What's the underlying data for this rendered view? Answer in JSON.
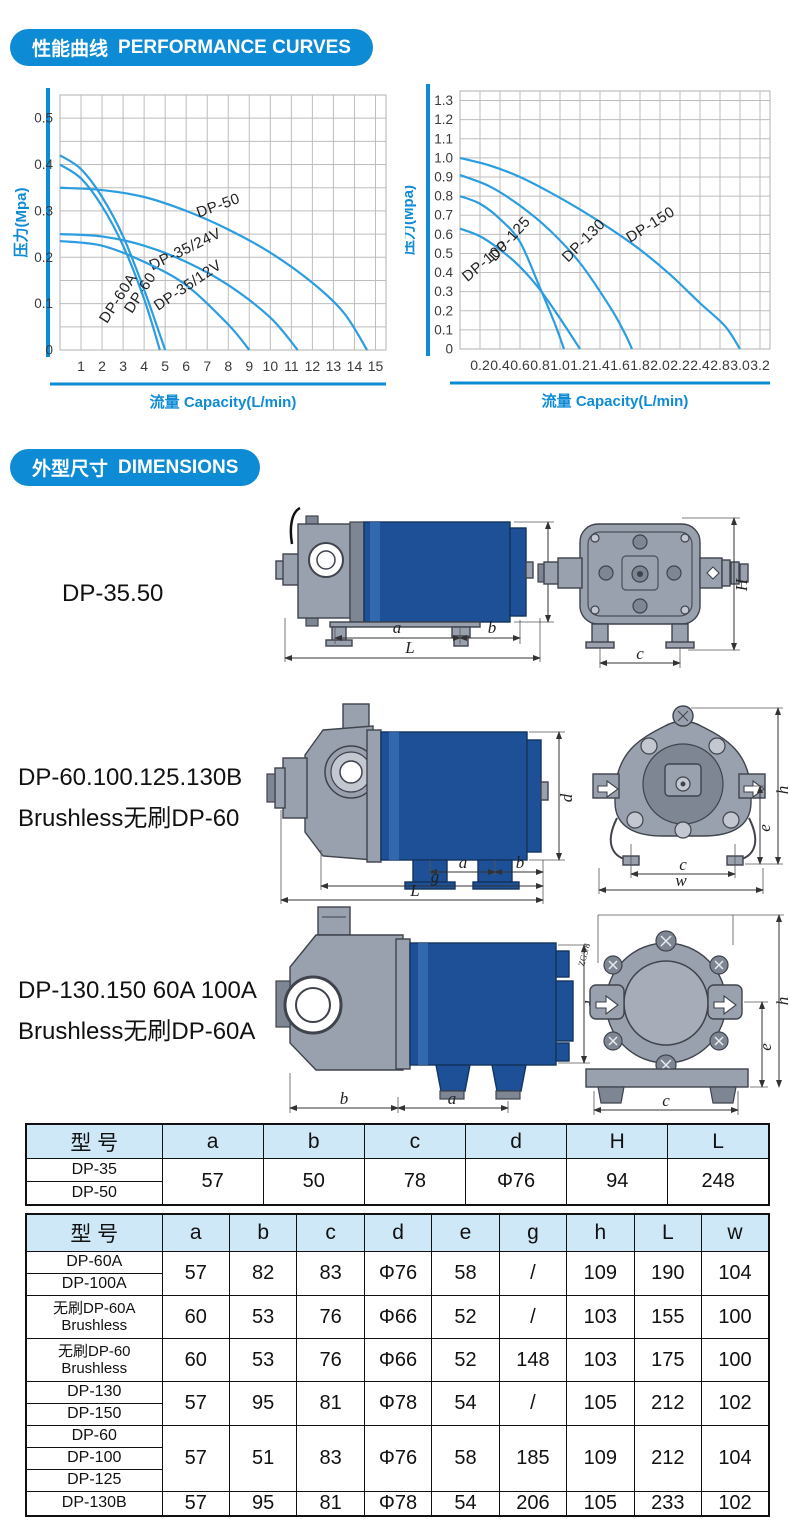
{
  "page": {
    "accent_blue": "#0e8bd5",
    "curve_blue": "#2b9de0",
    "grid_grey": "#bdbdbd",
    "table_header_bg": "#cfe8f8",
    "pump_blue": "#1d5096",
    "pump_grey": "#9aa1ae"
  },
  "sections": {
    "performance": {
      "title_cn": "性能曲线",
      "title_en": "PERFORMANCE CURVES"
    },
    "dimensions": {
      "title_cn": "外型尺寸",
      "title_en": "DIMENSIONS"
    }
  },
  "chart_data": [
    {
      "type": "line",
      "title": "",
      "xlabel": "流量 Capacity(L/min)",
      "ylabel": "压力(Mpa)",
      "xlim": [
        0,
        15.5
      ],
      "ylim": [
        0,
        0.55
      ],
      "x_gridstep": 1,
      "y_gridstep": 0.05,
      "grid": true,
      "legend_position": "labels-on-curves",
      "xticks": [
        [
          1,
          "1"
        ],
        [
          2,
          "2"
        ],
        [
          3,
          "3"
        ],
        [
          4,
          "4"
        ],
        [
          5,
          "5"
        ],
        [
          6,
          "6"
        ],
        [
          7,
          "7"
        ],
        [
          8,
          "8"
        ],
        [
          9,
          "9"
        ],
        [
          10,
          "10"
        ],
        [
          11,
          "11"
        ],
        [
          12,
          "12"
        ],
        [
          13,
          "13"
        ],
        [
          14,
          "14"
        ],
        [
          15,
          "15"
        ]
      ],
      "yticks": [
        [
          0,
          "0"
        ],
        [
          0.1,
          "0.1"
        ],
        [
          0.2,
          "0.2"
        ],
        [
          0.3,
          "0.3"
        ],
        [
          0.4,
          "0.4"
        ],
        [
          0.5,
          "0.5"
        ]
      ],
      "series": [
        {
          "name": "DP-50",
          "points": [
            [
              0,
              0.35
            ],
            [
              2,
              0.345
            ],
            [
              4,
              0.33
            ],
            [
              6,
              0.3
            ],
            [
              8,
              0.26
            ],
            [
              10,
              0.21
            ],
            [
              12,
              0.145
            ],
            [
              13.5,
              0.08
            ],
            [
              14.6,
              0
            ]
          ],
          "label": {
            "x": 7.6,
            "y": 0.302,
            "rot": -20
          }
        },
        {
          "name": "DP-35/24V",
          "points": [
            [
              0,
              0.25
            ],
            [
              2,
              0.245
            ],
            [
              4,
              0.225
            ],
            [
              6,
              0.19
            ],
            [
              8,
              0.14
            ],
            [
              10,
              0.07
            ],
            [
              11.3,
              0
            ]
          ],
          "label": {
            "x": 6.05,
            "y": 0.208,
            "rot": -26
          }
        },
        {
          "name": "DP-35/12V",
          "points": [
            [
              0,
              0.235
            ],
            [
              2,
              0.225
            ],
            [
              4,
              0.19
            ],
            [
              6,
              0.14
            ],
            [
              8,
              0.055
            ],
            [
              9,
              0
            ]
          ],
          "label": {
            "x": 6.2,
            "y": 0.131,
            "rot": -34
          }
        },
        {
          "name": "DP-60",
          "points": [
            [
              0,
              0.42
            ],
            [
              1,
              0.39
            ],
            [
              2,
              0.33
            ],
            [
              3,
              0.245
            ],
            [
              4,
              0.13
            ],
            [
              5,
              0
            ]
          ],
          "label": {
            "x": 4.0,
            "y": 0.118,
            "rot": -57
          }
        },
        {
          "name": "DP-60A",
          "points": [
            [
              0,
              0.4
            ],
            [
              1,
              0.37
            ],
            [
              2,
              0.31
            ],
            [
              3,
              0.225
            ],
            [
              4,
              0.11
            ],
            [
              4.75,
              0
            ]
          ],
          "label": {
            "x": 2.95,
            "y": 0.106,
            "rot": -57
          }
        }
      ]
    },
    {
      "type": "line",
      "title": "",
      "xlabel": "流量 Capacity(L/min)",
      "ylabel": "压力(Mpa)",
      "xlim": [
        0,
        3.1
      ],
      "ylim": [
        0,
        1.35
      ],
      "x_gridstep": 0.2,
      "y_gridstep": 0.1,
      "grid": true,
      "legend_position": "labels-on-curves",
      "xticks": [
        [
          0.2,
          "0.2"
        ],
        [
          0.4,
          "0.4"
        ],
        [
          0.6,
          "0.6"
        ],
        [
          0.8,
          "0.8"
        ],
        [
          1,
          "1.0"
        ],
        [
          1.2,
          "1.2"
        ],
        [
          1.4,
          "1.4"
        ],
        [
          1.6,
          "1.6"
        ],
        [
          1.8,
          "1.8"
        ],
        [
          2,
          "2.0"
        ],
        [
          2.2,
          "2.2"
        ],
        [
          2.4,
          "2.4"
        ],
        [
          2.6,
          "2.8"
        ],
        [
          2.8,
          "3.0"
        ],
        [
          3,
          "3.2"
        ]
      ],
      "yticks": [
        [
          0,
          "0"
        ],
        [
          0.1,
          "0.1"
        ],
        [
          0.2,
          "0.2"
        ],
        [
          0.3,
          "0.3"
        ],
        [
          0.4,
          "0.4"
        ],
        [
          0.5,
          "0.5"
        ],
        [
          0.6,
          "0.6"
        ],
        [
          0.7,
          "0.7"
        ],
        [
          0.8,
          "0.8"
        ],
        [
          0.9,
          "0.9"
        ],
        [
          1,
          "1.0"
        ],
        [
          1.1,
          "1.1"
        ],
        [
          1.2,
          "1.2"
        ],
        [
          1.3,
          "1.3"
        ]
      ],
      "series": [
        {
          "name": "DP-150",
          "points": [
            [
              0,
              1.0
            ],
            [
              0.3,
              0.96
            ],
            [
              0.6,
              0.9
            ],
            [
              0.9,
              0.82
            ],
            [
              1.2,
              0.73
            ],
            [
              1.5,
              0.63
            ],
            [
              1.8,
              0.52
            ],
            [
              2.1,
              0.39
            ],
            [
              2.4,
              0.24
            ],
            [
              2.65,
              0.12
            ],
            [
              2.8,
              0
            ]
          ],
          "label": {
            "x": 1.93,
            "y": 0.63,
            "rot": -32
          }
        },
        {
          "name": "DP-130",
          "points": [
            [
              0,
              0.91
            ],
            [
              0.3,
              0.85
            ],
            [
              0.6,
              0.75
            ],
            [
              0.9,
              0.62
            ],
            [
              1.2,
              0.45
            ],
            [
              1.5,
              0.22
            ],
            [
              1.65,
              0.08
            ],
            [
              1.72,
              0
            ]
          ],
          "label": {
            "x": 1.27,
            "y": 0.55,
            "rot": -45
          }
        },
        {
          "name": "DP-125",
          "points": [
            [
              0,
              0.8
            ],
            [
              0.2,
              0.76
            ],
            [
              0.4,
              0.68
            ],
            [
              0.6,
              0.56
            ],
            [
              0.8,
              0.32
            ],
            [
              0.95,
              0.13
            ],
            [
              1.04,
              0
            ]
          ],
          "label": {
            "x": 0.53,
            "y": 0.56,
            "rot": -48
          }
        },
        {
          "name": "DP-100",
          "points": [
            [
              0,
              0.63
            ],
            [
              0.2,
              0.59
            ],
            [
              0.4,
              0.52
            ],
            [
              0.6,
              0.43
            ],
            [
              0.8,
              0.31
            ],
            [
              1.0,
              0.16
            ],
            [
              1.2,
              0
            ]
          ],
          "label": {
            "x": 0.28,
            "y": 0.44,
            "rot": -40
          }
        }
      ]
    }
  ],
  "diagrams": [
    {
      "model": "DP-35.50",
      "model2": "",
      "dims": {
        "a": "a",
        "b": "b",
        "L": "L",
        "d": "d",
        "c": "c",
        "H": "H"
      }
    },
    {
      "model": "DP-60.100.125.130B",
      "model2": "Brushless无刷DP-60",
      "dims": {
        "a": "a",
        "b": "b",
        "g": "g",
        "L": "L",
        "d": "d",
        "c": "c",
        "w": "w",
        "e": "e",
        "h": "h"
      }
    },
    {
      "model": "DP-130.150 60A 100A",
      "model2": "Brushless无刷DP-60A",
      "dims": {
        "a": "a",
        "b": "b",
        "d": "d",
        "c": "c",
        "e": "e",
        "h": "h",
        "thread": "ZG3/8"
      }
    }
  ],
  "tables": [
    {
      "headers": [
        "型 号",
        "a",
        "b",
        "c",
        "d",
        "H",
        "L"
      ],
      "groups": [
        {
          "labels": [
            "DP-35",
            "DP-50"
          ],
          "values": [
            "57",
            "50",
            "78",
            "Φ76",
            "94",
            "248"
          ]
        }
      ]
    },
    {
      "headers": [
        "型 号",
        "a",
        "b",
        "c",
        "d",
        "e",
        "g",
        "h",
        "L",
        "w"
      ],
      "groups": [
        {
          "labels": [
            "DP-60A",
            "DP-100A"
          ],
          "values": [
            "57",
            "82",
            "83",
            "Φ76",
            "58",
            "/",
            "109",
            "190",
            "104"
          ]
        },
        {
          "labels": [
            "无刷DP-60A\nBrushless"
          ],
          "values": [
            "60",
            "53",
            "76",
            "Φ66",
            "52",
            "/",
            "103",
            "155",
            "100"
          ]
        },
        {
          "labels": [
            "无刷DP-60\nBrushless"
          ],
          "values": [
            "60",
            "53",
            "76",
            "Φ66",
            "52",
            "148",
            "103",
            "175",
            "100"
          ]
        },
        {
          "labels": [
            "DP-130",
            "DP-150"
          ],
          "values": [
            "57",
            "95",
            "81",
            "Φ78",
            "54",
            "/",
            "105",
            "212",
            "102"
          ]
        },
        {
          "labels": [
            "DP-60",
            "DP-100",
            "DP-125"
          ],
          "values": [
            "57",
            "51",
            "83",
            "Φ76",
            "58",
            "185",
            "109",
            "212",
            "104"
          ]
        },
        {
          "labels": [
            "DP-130B"
          ],
          "values": [
            "57",
            "95",
            "81",
            "Φ78",
            "54",
            "206",
            "105",
            "233",
            "102"
          ]
        }
      ]
    }
  ]
}
